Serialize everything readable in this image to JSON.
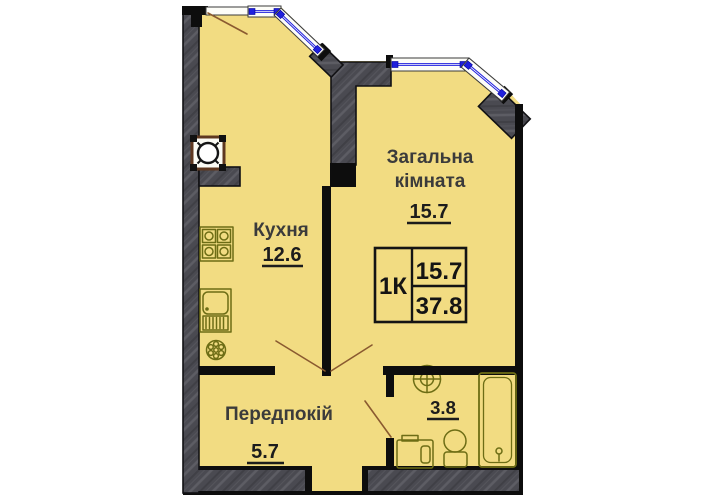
{
  "plan_title": "Apartment floor plan 1K",
  "rooms": {
    "living": {
      "label_line1": "Загальна",
      "label_line2": "кімната",
      "area": "15.7"
    },
    "kitchen": {
      "label": "Кухня",
      "area": "12.6"
    },
    "hallway": {
      "label": "Передпокій",
      "area": "5.7"
    },
    "bathroom": {
      "area": "3.8"
    }
  },
  "legend": {
    "apartment_type": "1К",
    "living_area": "15.7",
    "total_area": "37.8"
  },
  "fixtures": {
    "kitchen": [
      "stove-icon",
      "sink-icon",
      "hob-icon",
      "vent-shaft-icon"
    ],
    "bathroom": [
      "washbasin-icon",
      "washing-machine-icon",
      "toilet-icon",
      "bathtub-icon"
    ]
  },
  "colors": {
    "floor": "#f2dc82",
    "structural_wall": "#4a4a51",
    "partition_wall": "#0d0d0d",
    "window": "#2020dd",
    "fixture": "#6d6d15",
    "door_swing": "#8a5a30"
  }
}
